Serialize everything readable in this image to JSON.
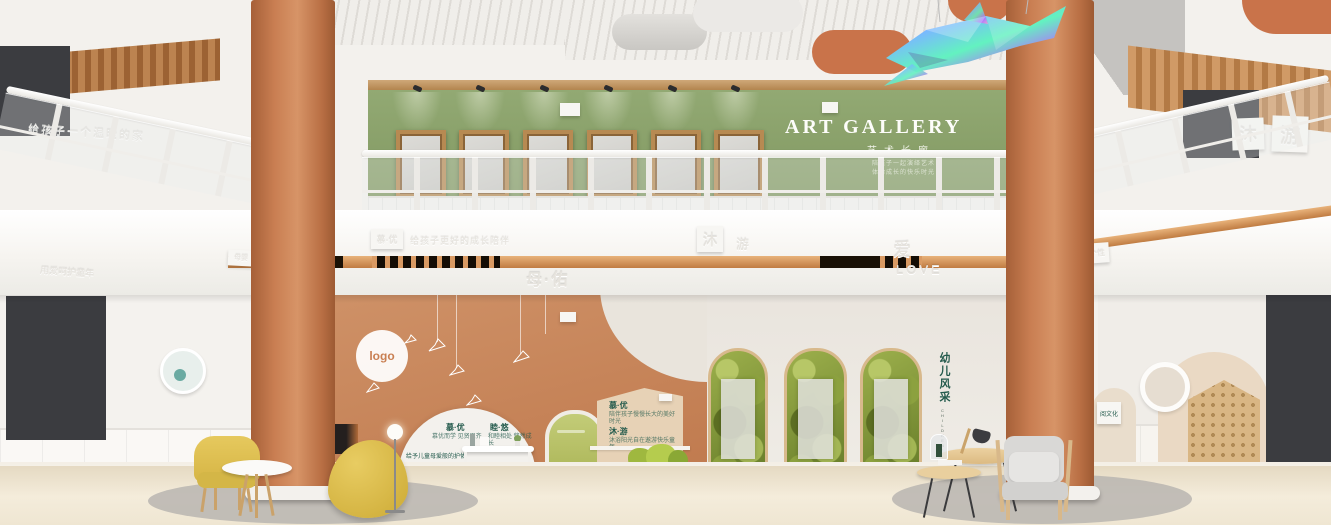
{
  "colors": {
    "terracotta": "#c07a4e",
    "terracotta_dark": "#9d5a33",
    "terracotta_light": "#d79467",
    "orange_wall": "#c98a5f",
    "green_wall": "#8aa06a",
    "teal": "#235a4c",
    "yellow": "#ddbf52",
    "floor": "#efe6d2",
    "copper": "#d99a63",
    "wood": "#c49a69",
    "leaf_dark": "#5c6e22",
    "leaf_mid": "#8ca13f",
    "leaf_light": "#b7c767",
    "beige_panel": "#e7d2b6",
    "door_green": "#bcc56f",
    "cloud_orange": "#c9734a"
  },
  "upper": {
    "gallery_title": "ART GALLERY",
    "gallery_subtitle": "艺术长廊",
    "gallery_tagline1": "陪孩子一起演绎艺术",
    "gallery_tagline2": "体验成长的快乐时光",
    "right_tile_mu": "沐",
    "right_tile_you": "游",
    "left_wall_emboss": "给孩子一个温暖的家"
  },
  "band": {
    "plaque_muyou": "慕·优",
    "emboss_left": "给孩子更好的成长陪伴",
    "plaque_small_left": "母婴",
    "far_left_emboss": "用爱呵护童年",
    "tile_mu": "沐",
    "tile_you": "游",
    "mu_you": "母·佑",
    "ai": "爱",
    "love": "LOVE",
    "emboss_right": "成长",
    "letters_right": "MUYOU",
    "plaque_right": "个性"
  },
  "orange_wall": {
    "logo": "logo",
    "arch": {
      "h1": "慕·优",
      "h2": "睦·悠",
      "p1": "慕优而学 见贤思齐",
      "p2": "和睦相处 悠然成长",
      "caption": "给予儿童母爱般的护佑",
      "title": "母·佑"
    },
    "house": {
      "h1": "慕·优",
      "p1": "陪伴孩子慢慢长大的美好时光",
      "h2": "沐·游",
      "p2": "沐浴阳光自在遨游快乐童年"
    }
  },
  "white_wall": {
    "kids_title": "幼儿风采",
    "kids_subtitle": "CHILDREN'S STYLE"
  },
  "right_wall": {
    "sign_title": "阅文化"
  }
}
